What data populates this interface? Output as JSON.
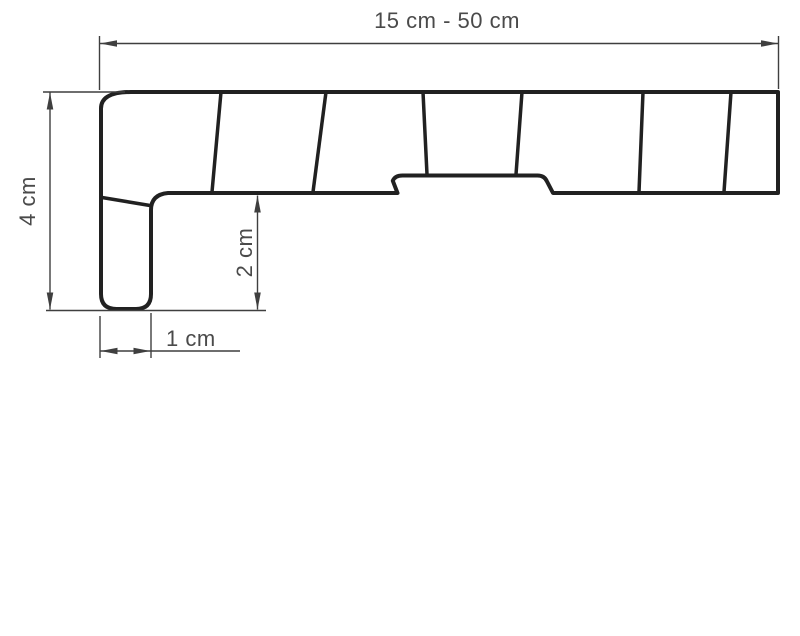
{
  "diagram": {
    "subject": "window-sill-profile-cross-section",
    "labels": {
      "width_range": "15 cm - 50 cm",
      "height": "4 cm",
      "front_edge_height": "2 cm",
      "front_edge_width": "1 cm"
    },
    "colors": {
      "background": "#ffffff",
      "profile_line": "#212121",
      "dimension_line": "#3f3f3f",
      "text": "#4a4a4a"
    }
  }
}
